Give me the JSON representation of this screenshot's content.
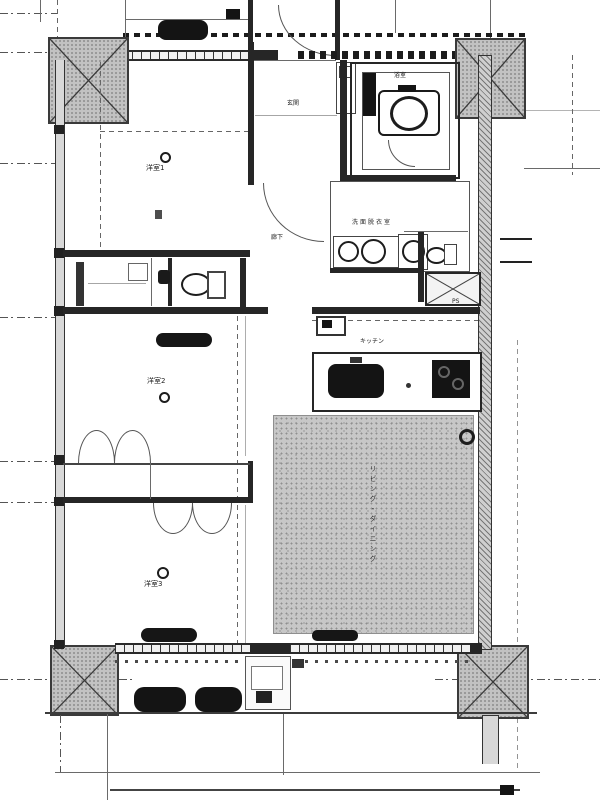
{
  "plan": {
    "type": "japanese-apartment-floor-plan",
    "labels": {
      "entrance": "玄関",
      "hallway": "廊下",
      "western1": "洋室1",
      "western2": "洋室2",
      "western3": "洋室3",
      "washroom": "洗面脱衣室",
      "bathroom": "浴室",
      "kitchen": "キッチン",
      "living": "リビング・ダイニング",
      "pipe_space": "PS"
    },
    "colors": {
      "wall": "#262626",
      "stipple_floor": "#c7c7c7",
      "column_fill": "#c2c2c2",
      "fixture_dark": "#141414",
      "line": "#6a6a6a",
      "background": "#ffffff"
    }
  }
}
